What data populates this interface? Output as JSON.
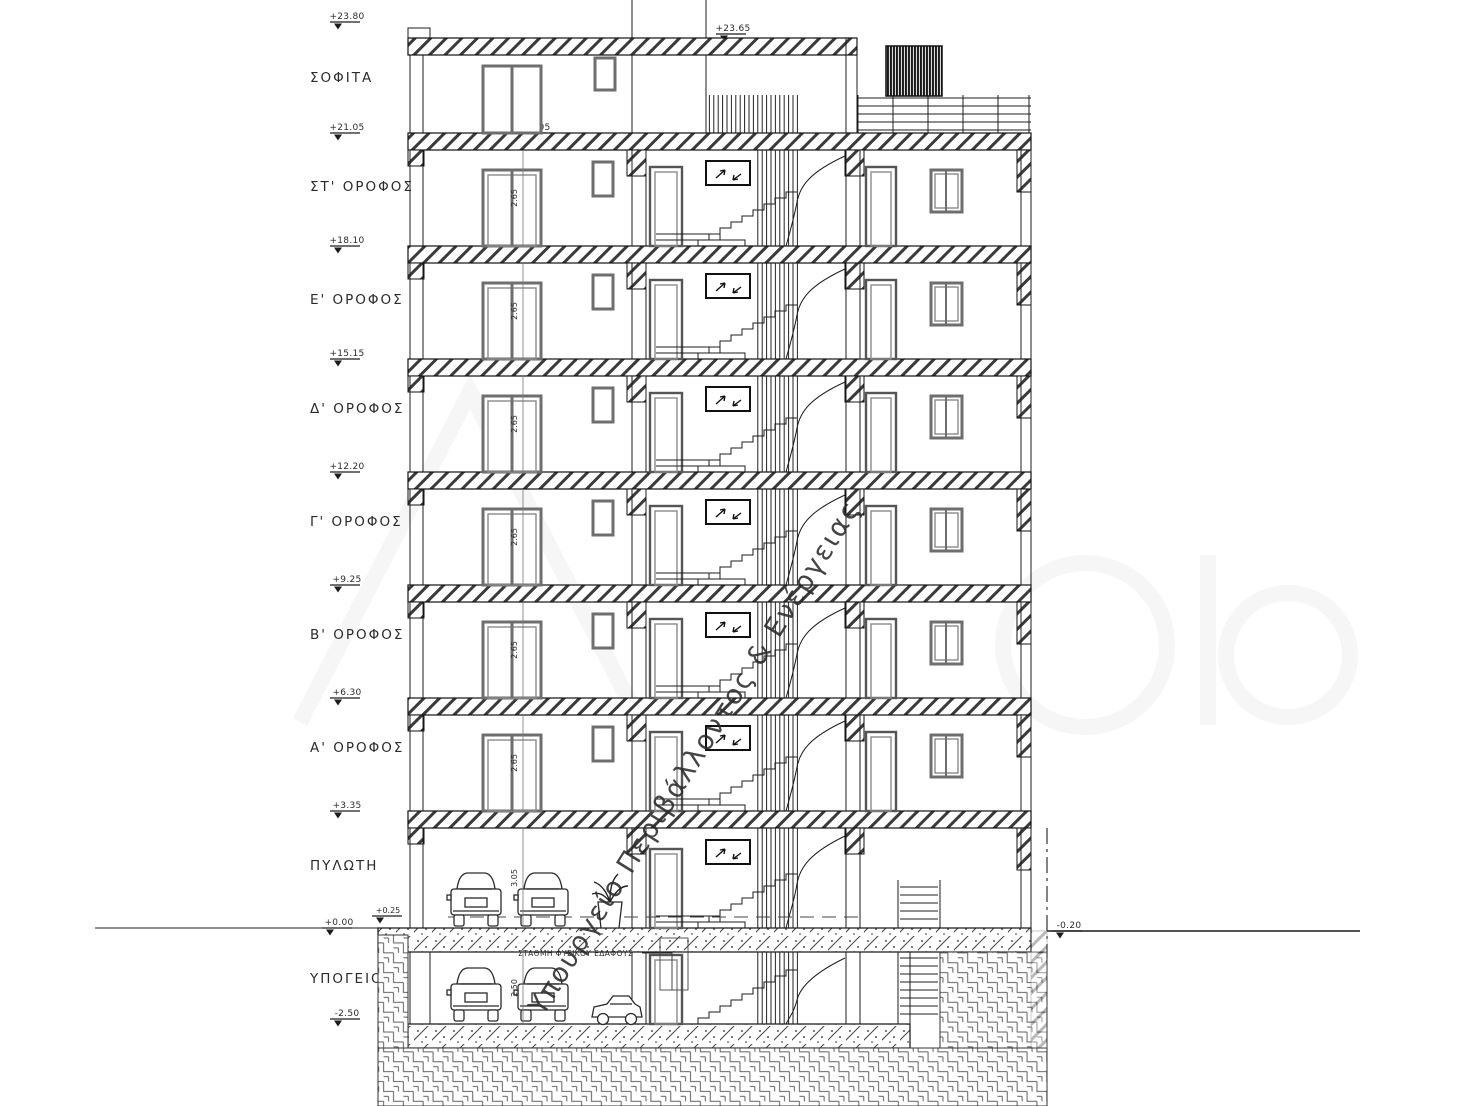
{
  "levels": [
    {
      "label": "ΣΟΦΙΤΑ",
      "elev": "+21.05"
    },
    {
      "label": "ΣΤ' ΟΡΟΦΟΣ",
      "elev": "+18.10"
    },
    {
      "label": "Ε' ΟΡΟΦΟΣ",
      "elev": "+15.15"
    },
    {
      "label": "Δ' ΟΡΟΦΟΣ",
      "elev": "+12.20"
    },
    {
      "label": "Γ' ΟΡΟΦΟΣ",
      "elev": "+9.25"
    },
    {
      "label": "Β' ΟΡΟΦΟΣ",
      "elev": "+6.30"
    },
    {
      "label": "Α' ΟΡΟΦΟΣ",
      "elev": "+3.35"
    },
    {
      "label": "ΠΥΛΩΤΗ",
      "elev": "+0.00"
    },
    {
      "label": "ΥΠΟΓΕΙΟ",
      "elev": "-2.50"
    }
  ],
  "elevations": {
    "parapetTop": "+23.80",
    "roofSlab": "+23.65",
    "pilotisSlab": "+0.25",
    "rightGround": "-0.20"
  },
  "dims": {
    "typicalFloor": "2.65",
    "pilotis": "3.05",
    "basement": "2.50"
  },
  "notes": {
    "naturalGround": "ΣΤΑΘΜΗ ΦΥΣΙΚΟΥ ΕΔΑΦΟΥΣ"
  },
  "watermark": {
    "text": "Υπουργείο Περιβάλλοντος & Ενέργειας",
    "color": "#7d7dd4"
  }
}
